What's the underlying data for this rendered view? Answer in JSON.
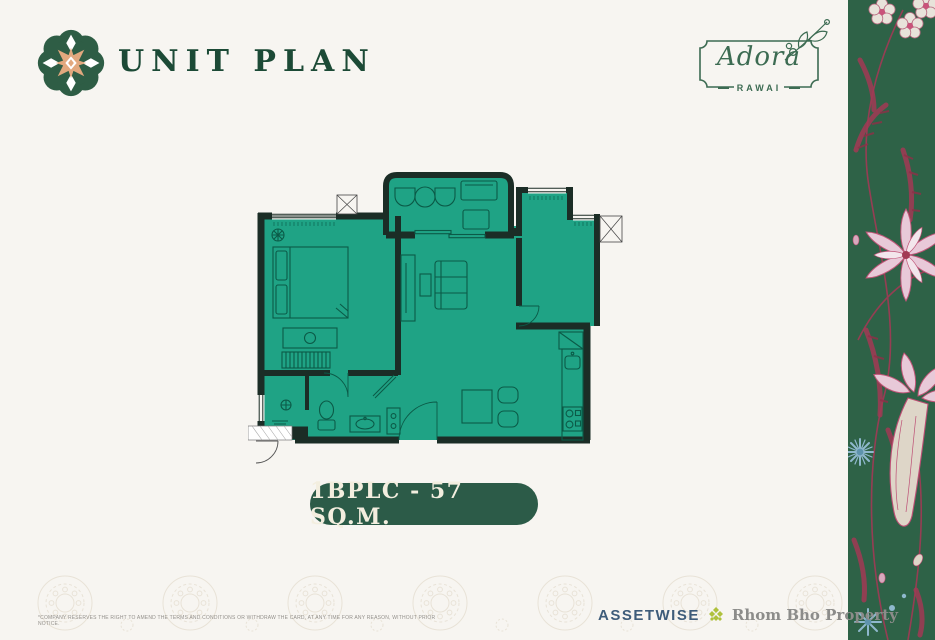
{
  "header": {
    "logo_icon": "rosette-ornament-icon",
    "title": "UNIT PLAN",
    "project": {
      "name": "Adora",
      "subtitle": "RAWAI",
      "decoration": "floral-sprig-icon"
    }
  },
  "floor_plan": {
    "unit_label": "1BPLC - 57 SQ.M.",
    "style": "top-down condo unit plan, teal rooms with dark walls"
  },
  "footer": {
    "disclaimer": "*COMPANY RESERVES THE RIGHT TO AMEND THE TERMS AND CONDITIONS OR WITHDRAW THE CARD, AT ANY TIME FOR ANY REASON, WITHOUT PRIOR NOTICE.",
    "brands": [
      {
        "name": "ASSETWISE"
      },
      {
        "name": "Rhom Bho Property",
        "icon": "diamond-cluster-icon"
      }
    ]
  },
  "colors": {
    "paper": "#f7f5f1",
    "plan_fill": "#1fa385",
    "wall": "#1b2d26",
    "furniture_line": "#0b5a47",
    "pill_green": "#2c5b48",
    "pill_text": "#f3eedf",
    "title_green": "#1c4a36",
    "adora_green": "#3c6b52",
    "strip_green": "#2e6247",
    "flower_pink": "#c9537a",
    "flower_crimson": "#a23a55",
    "flower_blue": "#8fb8cd",
    "assetwise_blue": "#3e5c7a",
    "brand_gray": "#8c8c8a",
    "rosette_peach": "#e2a87e"
  }
}
